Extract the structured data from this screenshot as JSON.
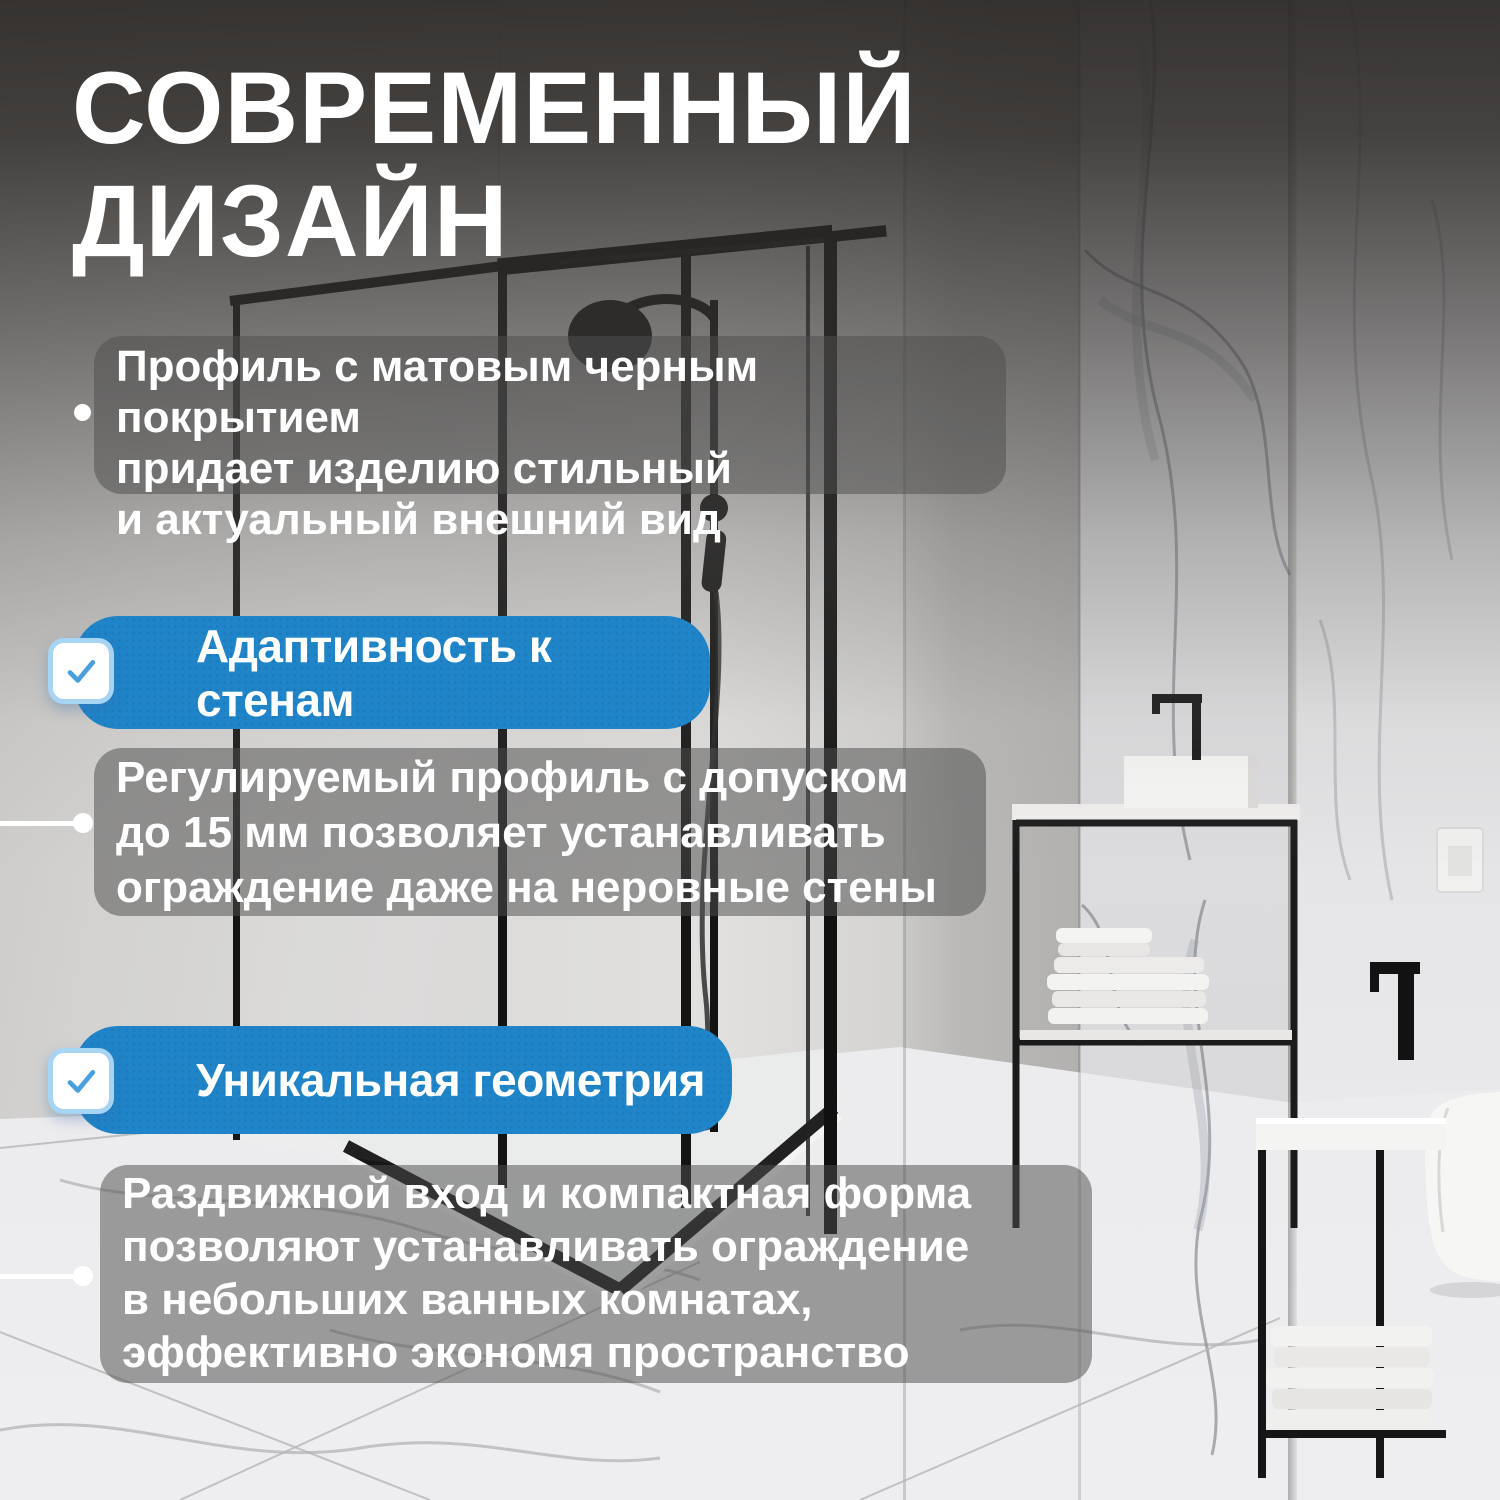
{
  "title": {
    "line1": "СОВРЕМЕННЫЙ",
    "line2": "ДИЗАЙН"
  },
  "feature_blocks": {
    "block1": {
      "lines": [
        "Профиль с матовым черным покрытием",
        "придает изделию стильный",
        "и актуальный внешний вид"
      ]
    },
    "block2": {
      "lines": [
        "Регулируемый профиль с допуском",
        "до 15 мм позволяет устанавливать",
        "ограждение даже на неровные стены"
      ]
    },
    "block3": {
      "lines": [
        "Раздвижной вход и компактная форма",
        "позволяют устанавливать ограждение",
        "в небольших ванных комнатах,",
        "эффективно экономя пространство"
      ]
    }
  },
  "badges": {
    "badge1": {
      "label": "Адаптивность к стенам",
      "icon": "checkbox-checked"
    },
    "badge2": {
      "label": "Уникальная геометрия",
      "icon": "checkbox-checked"
    }
  },
  "colors": {
    "badge_blue": "#1f84c8",
    "checkbox_border": "#a6d4f2",
    "checkbox_check": "#4aa0dd",
    "text_color": "#ffffff",
    "overlay_grey": "#4f4f4f",
    "frame_black": "#161616"
  }
}
